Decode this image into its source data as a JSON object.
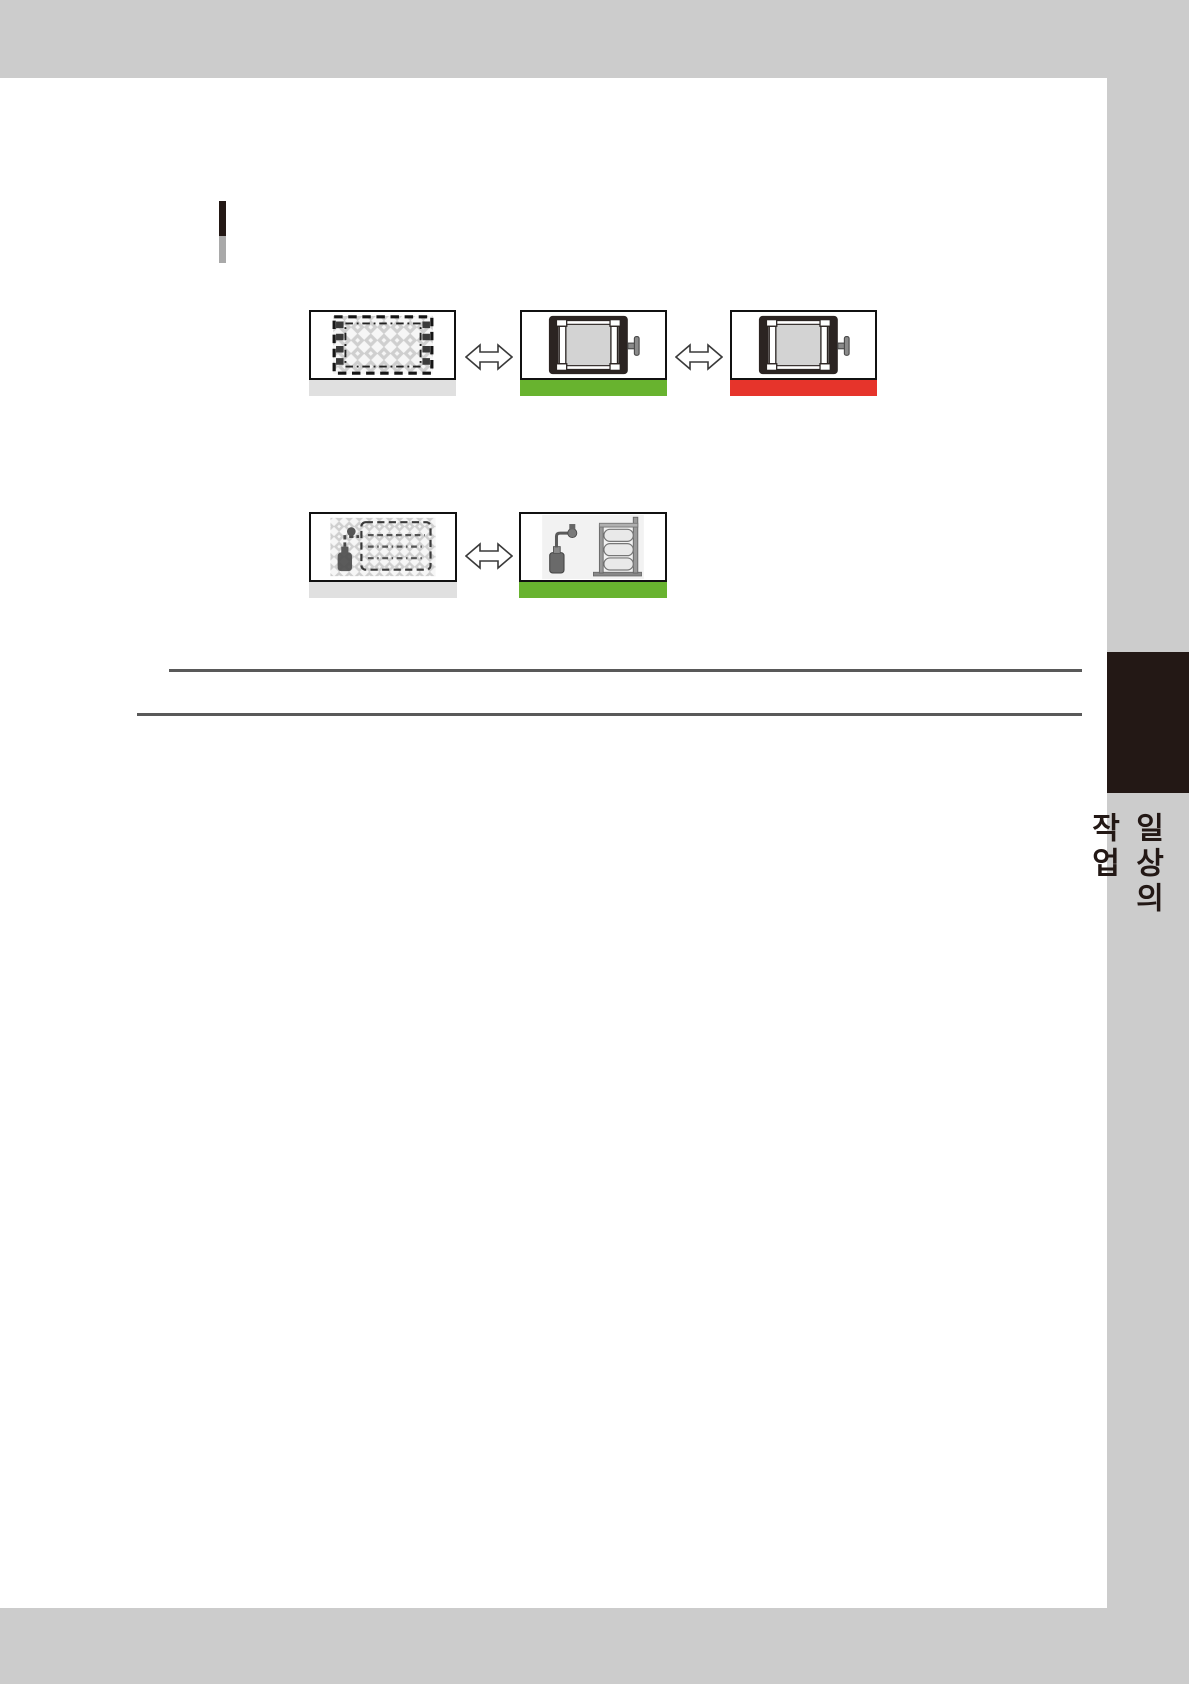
{
  "page": {
    "width": 1189,
    "height": 1684,
    "colors": {
      "chrome_gray": "#cccccc",
      "page_bg": "#ffffff",
      "tab_bg": "#231815",
      "rule_gray": "#595959",
      "marker_top": "#231815",
      "marker_bottom": "#a9a9a9",
      "bar_gray": "#e0e0e0",
      "bar_green": "#68b32f",
      "bar_red": "#e6342b"
    }
  },
  "sidebar": {
    "chapter_tab_label": "일상의 작업"
  },
  "icons": {
    "arrow": "left-right-double-arrow-icon",
    "row1_card1": "slot-empty-crosshatch-illustration",
    "row1_card2": "device-installed-frame-illustration",
    "row1_card3": "device-installed-frame-illustration",
    "row2_card1": "stack-device-crosshatch-illustration",
    "row2_card2": "stack-device-with-pump-illustration"
  },
  "diagram_row1": {
    "cards": [
      {
        "state": "not-installed",
        "bar": "gray"
      },
      {
        "state": "installed-ok",
        "bar": "green"
      },
      {
        "state": "installed-error",
        "bar": "red"
      }
    ]
  },
  "diagram_row2": {
    "cards": [
      {
        "state": "not-installed",
        "bar": "gray"
      },
      {
        "state": "installed-ok",
        "bar": "green"
      }
    ]
  }
}
